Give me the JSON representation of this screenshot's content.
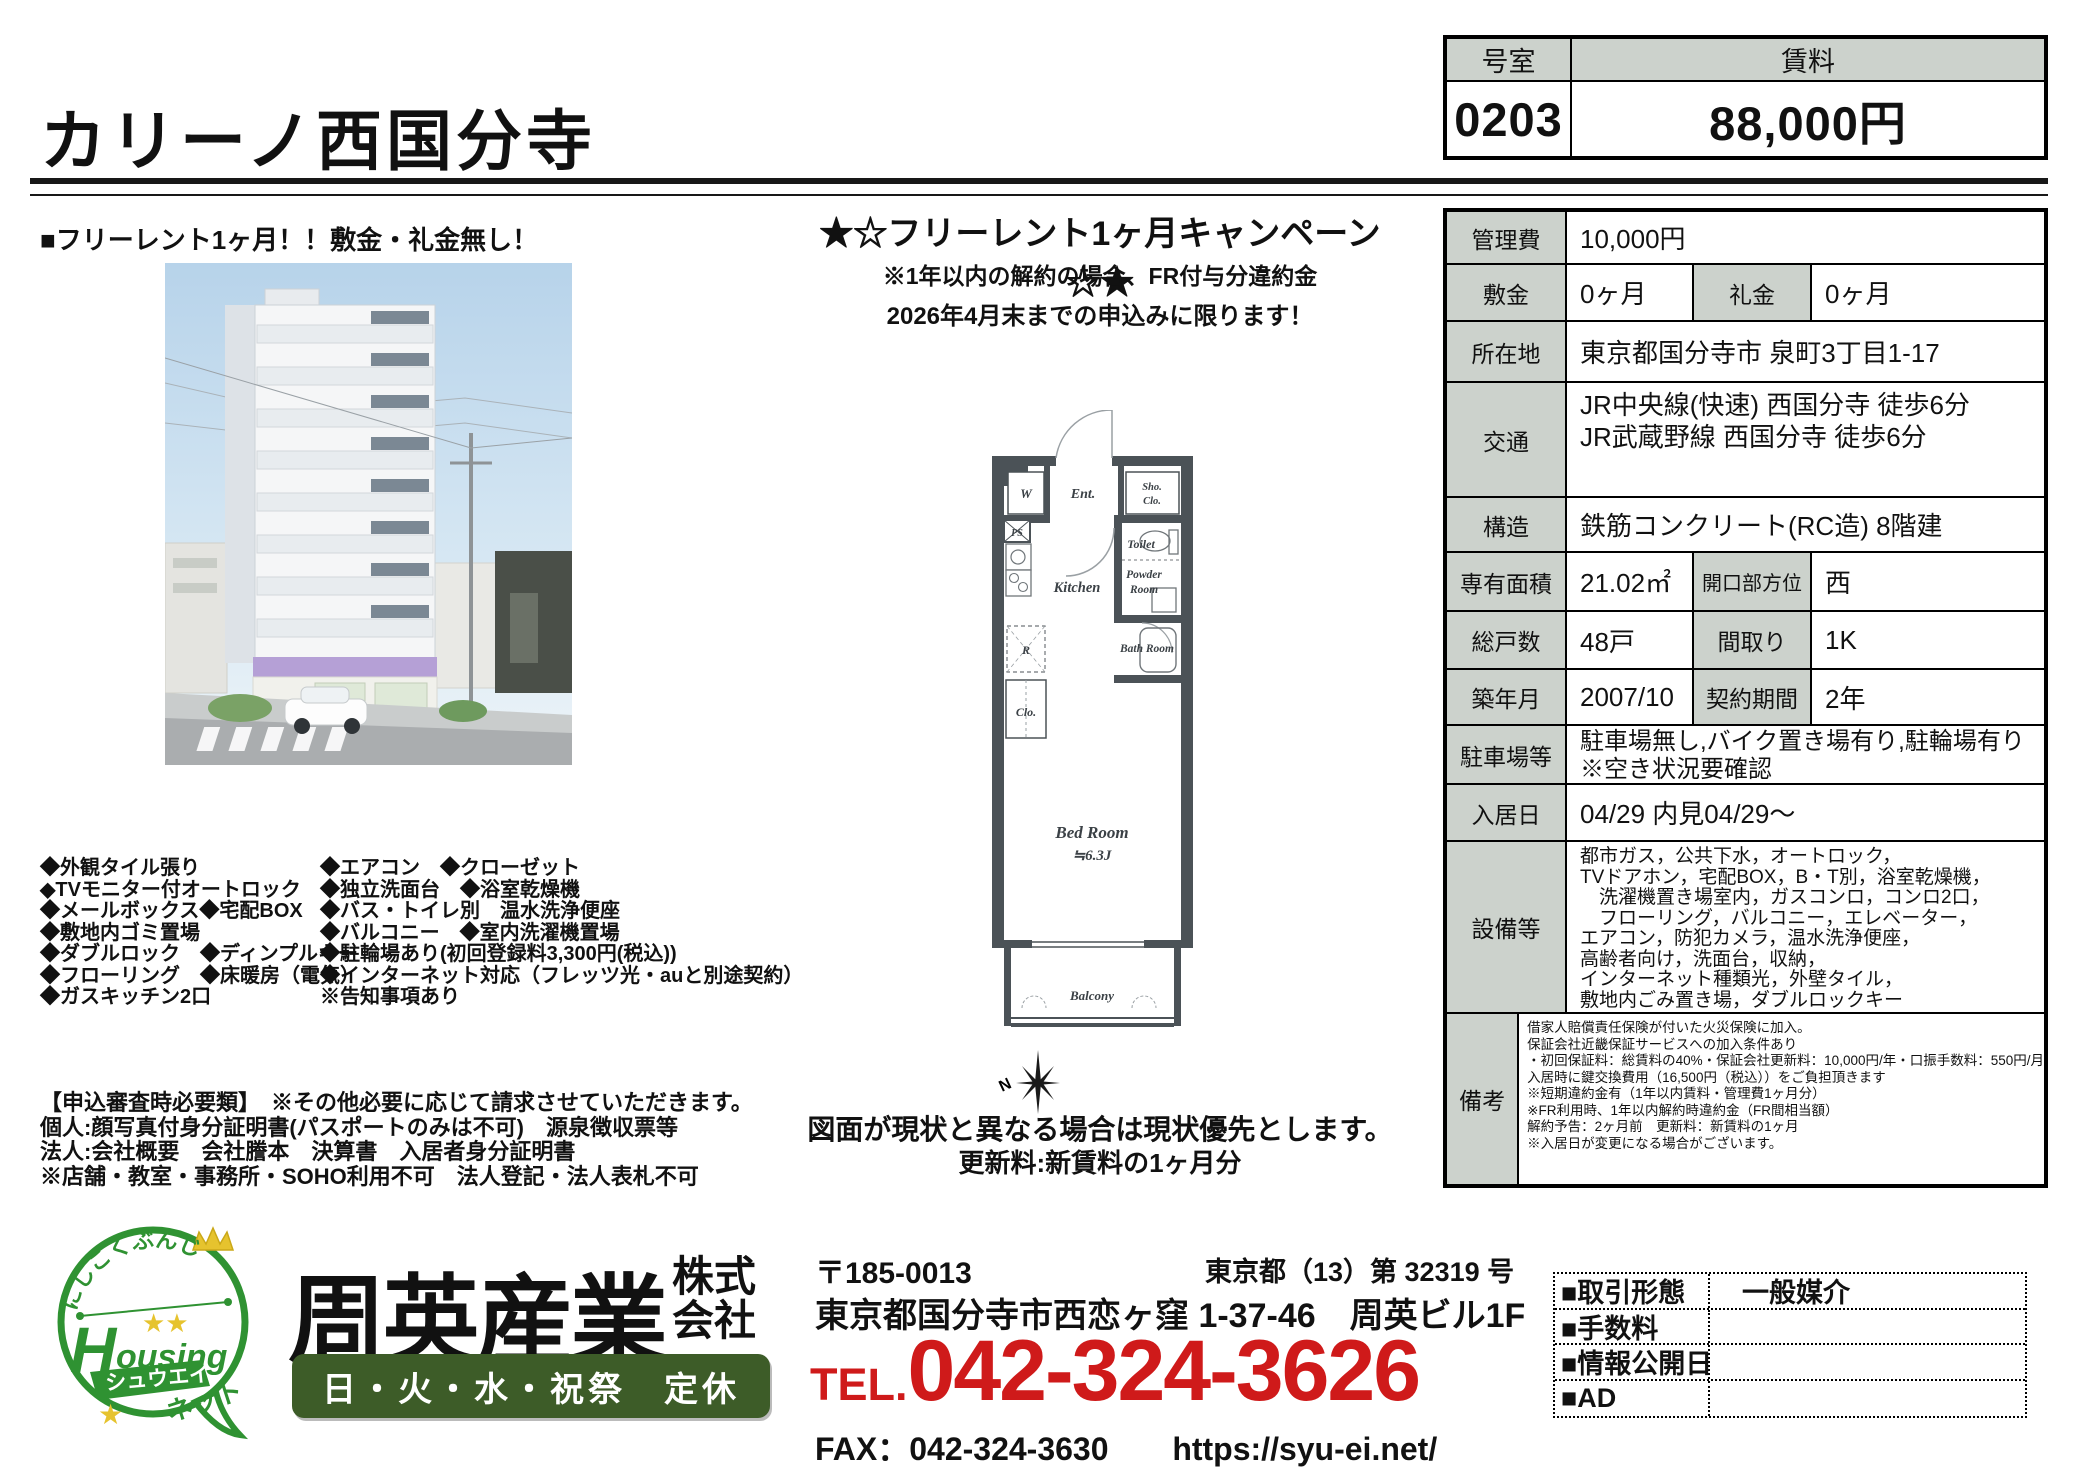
{
  "header": {
    "title": "カリーノ西国分寺"
  },
  "price_box": {
    "room_label": "号室",
    "rent_label": "賃料",
    "room": "0203",
    "rent": "88,000円"
  },
  "left": {
    "catch": "■フリーレント1ヶ月！！敷金・礼金無し！",
    "features_col1": [
      "◆外観タイル張り",
      "◆TVモニター付オートロック",
      "◆メールボックス◆宅配BOX",
      "◆敷地内ゴミ置場",
      "◆ダブルロック　◆ディンプルキー",
      "◆フローリング　◆床暖房（電気）",
      "◆ガスキッチン2口"
    ],
    "features_col2": [
      "◆エアコン　◆クローゼット",
      "◆独立洗面台　◆浴室乾燥機",
      "◆バス・トイレ別　温水洗浄便座",
      "◆バルコニー　◆室内洗濯機置場",
      "◆駐輪場あり(初回登録料3,300円(税込))",
      "◆インターネット対応（フレッツ光・auと別途契約）",
      "※告知事項あり"
    ],
    "application_notes": [
      "【申込審査時必要類】　※その他必要に応じて請求させていただきます。",
      "個人:顔写真付身分証明書(パスポートのみは不可)　源泉徴収票等",
      "法人:会社概要　会社謄本　決算書　入居者身分証明書",
      "※店舗・教室・事務所・SOHO利用不可　法人登記・法人表札不可"
    ]
  },
  "center": {
    "campaign_title": "★☆フリーレント1ヶ月キャンペーン☆★",
    "campaign_note1": "※1年以内の解約の場合、FR付与分違約金",
    "campaign_note2": "2026年4月末までの申込みに限ります！",
    "plan_note1": "図面が現状と異なる場合は現状優先とします。",
    "plan_note2": "更新料:新賃料の1ヶ月分",
    "floorplan": {
      "w": "W",
      "ent": "Ent.",
      "sho": "Sho.",
      "sho2": "Clo.",
      "ps": "PS",
      "kitchen": "Kitchen",
      "toilet": "Toilet",
      "powder1": "Powder",
      "powder2": "Room",
      "bath": "Bath Room",
      "r": "R",
      "clo": "Clo.",
      "bedroom": "Bed Room",
      "size": "≒6.3J",
      "balcony": "Balcony",
      "compass_n": "N"
    }
  },
  "details": {
    "kanrihi_label": "管理費",
    "kanrihi": "10,000円",
    "shikikin_label": "敷金",
    "shikikin": "0ヶ月",
    "reikin_label": "礼金",
    "reikin": "0ヶ月",
    "shozaichi_label": "所在地",
    "shozaichi": "東京都国分寺市 泉町3丁目1-17",
    "kotsu_label": "交通",
    "kotsu1": "JR中央線(快速) 西国分寺 徒歩6分",
    "kotsu2": "JR武蔵野線 西国分寺 徒歩6分",
    "kozo_label": "構造",
    "kozo": "鉄筋コンクリート(RC造) 8階建",
    "menseki_label": "専有面積",
    "menseki": "21.02㎡",
    "hoi_label": "開口部方位",
    "hoi": "西",
    "kosu_label": "総戸数",
    "kosu": "48戸",
    "madori_label": "間取り",
    "madori": "1K",
    "chikunen_label": "築年月",
    "chikunen": "2007/10",
    "keiyaku_label": "契約期間",
    "keiyaku": "2年",
    "parking_label": "駐車場等",
    "parking": "駐車場無し,バイク置き場有り,駐輪場有り　※空き状況要確認",
    "nyukyo_label": "入居日",
    "nyukyo": "04/29 内見04/29～",
    "setsubi_label": "設備等",
    "setsubi_lines": [
      "都市ガス，公共下水，オートロック，",
      "TVドアホン，宅配BOX，B・T別，浴室乾燥機，",
      "　洗濯機置き場室内，ガスコンロ，コンロ2口，",
      "　フローリング，バルコニー，エレベーター，",
      "エアコン，防犯カメラ，温水洗浄便座，",
      "高齢者向け，洗面台，収納，",
      "インターネット種類光，外壁タイル，",
      "敷地内ごみ置き場，ダブルロックキー"
    ],
    "biko_label": "備考",
    "biko_lines": [
      "借家人賠償責任保険が付いた火災保険に加入。",
      "保証会社近畿保証サービスへの加入条件あり",
      "・初回保証料：総賃料の40%・保証会社更新料：10,000円/年・口振手数料：550円/月",
      "入居時に鍵交換費用（16,500円（税込））をご負担頂きます",
      "※短期違約金有（1年以内賃料・管理費1ヶ月分）",
      "※FR利用時、1年以内解約時違約金（FR間相当額）",
      "解約予告：2ヶ月前　更新料：新賃料の1ヶ月",
      "※入居日が変更になる場合がございます。"
    ]
  },
  "footer": {
    "logo": {
      "arc": "にしこくぶんじ",
      "housing_h": "H",
      "housing_rest": "ousing",
      "katakana": "シュウエイ",
      "net": "ネット"
    },
    "company": "周英産業",
    "company_suffix1": "株式",
    "company_suffix2": "会社",
    "closed": "日・火・水・祝祭　定休",
    "postal": "〒185-0013",
    "license": "東京都（13）第 32319 号",
    "address": "東京都国分寺市西恋ヶ窪 1-37-46　周英ビル1F",
    "tel_label": "TEL.",
    "tel": "042-324-3626",
    "fax": "FAX：042-324-3630",
    "url": "https://syu-ei.net/",
    "deal": [
      {
        "label": "■取引形態",
        "value": "一般媒介"
      },
      {
        "label": "■手数料",
        "value": ""
      },
      {
        "label": "■情報公開日",
        "value": ""
      },
      {
        "label": "■AD",
        "value": ""
      }
    ]
  },
  "colors": {
    "header_gray": "#ccd2cc",
    "accent_red": "#cf1a1a",
    "logo_green": "#2f9232",
    "closed_bar_green": "#3d5c28",
    "plan_wall": "#4b5257",
    "star_yellow": "#e6c32e"
  }
}
